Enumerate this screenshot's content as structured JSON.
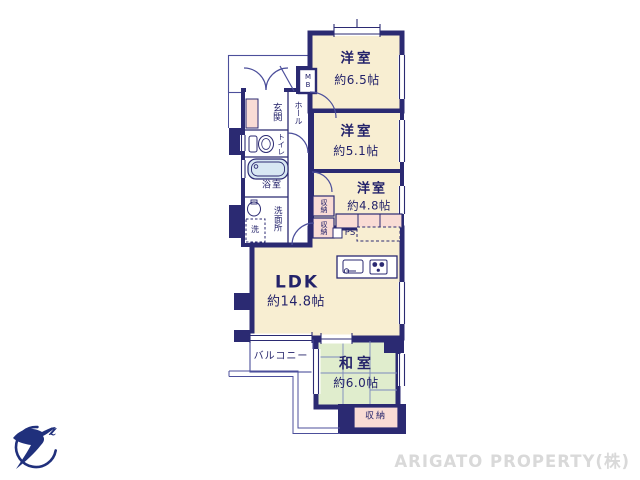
{
  "canvas": {
    "width": 640,
    "height": 480,
    "background": "#ffffff"
  },
  "colors": {
    "wall_navy": "#2b2a72",
    "thin_line": "#4c4f9b",
    "room_cream": "#f8eed2",
    "closet_pink": "#f9dcd5",
    "tatami_green": "#e0edcd",
    "bath_blue": "#d8e7f3",
    "label_text": "#23226a",
    "watermark_gray": "#d9d9d9",
    "logo_navy": "#20307c"
  },
  "floorplan": {
    "rooms": [
      {
        "name": "洋室",
        "size": "約6.5帖"
      },
      {
        "name": "洋室",
        "size": "約5.1帖"
      },
      {
        "name": "洋室",
        "size": "約4.8帖"
      },
      {
        "name": "LDK",
        "size": "約14.8帖"
      },
      {
        "name": "和室",
        "size": "約6.0帖"
      }
    ],
    "labels": {
      "balcony": "バルコニー",
      "entrance": "玄関",
      "hall": "ホール",
      "toilet": "トイレ",
      "bath": "浴室",
      "washroom": "洗面所",
      "washing_machine": "洗",
      "closet_upper": "収納",
      "closet_lower": "収納",
      "closet_washitsu": "収納",
      "pipe_space": "PS",
      "meter_box": "MB"
    },
    "icons": {
      "toilet": "toilet-icon",
      "bathtub": "bathtub-icon",
      "wash_basin": "wash-basin-icon",
      "kitchen_sink": "kitchen-sink-icon",
      "stove": "stove-icon",
      "shoe_cabinet": "shoe-cabinet"
    }
  },
  "branding": {
    "watermark": "ARIGATO PROPERTY(株)",
    "logo_glyph": "z"
  }
}
